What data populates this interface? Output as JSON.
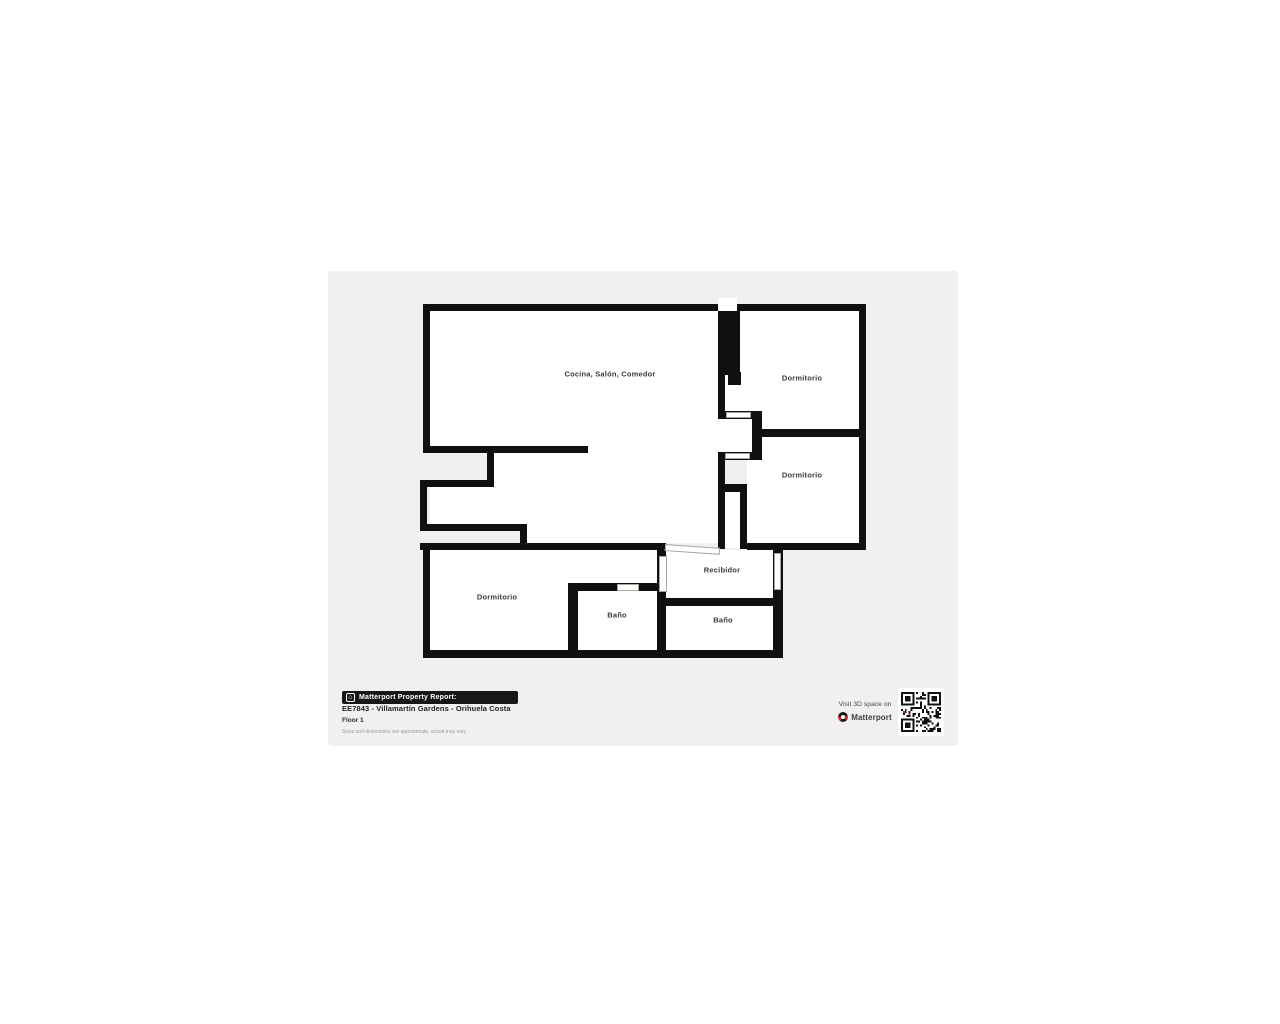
{
  "report": {
    "badge_label": "Matterport Property Report:",
    "title": "EE7843 - Villamartín Gardens - Orihuela Costa",
    "floor_label": "Floor 1",
    "disclaimer": "Sizes and dimensions are approximate, actual may vary"
  },
  "rooms": [
    {
      "label": "Cocina, Salón, Comedor"
    },
    {
      "label": "Dormitorio"
    },
    {
      "label": "Dormitorio"
    },
    {
      "label": "Recibidor"
    },
    {
      "label": "Dormitorio"
    },
    {
      "label": "Baño"
    },
    {
      "label": "Baño"
    }
  ],
  "cta": {
    "visit_text": "Visit 3D space on",
    "brand": "Matterport"
  },
  "icons": {
    "badge_house_icon": "⌂"
  },
  "colors": {
    "panel_background": "#f1f0ee",
    "wall": "#101010",
    "room_fill": "#ffffff",
    "label_text": "#3a3a3a",
    "matterport_red": "#c62828",
    "badge_background": "#171717"
  }
}
